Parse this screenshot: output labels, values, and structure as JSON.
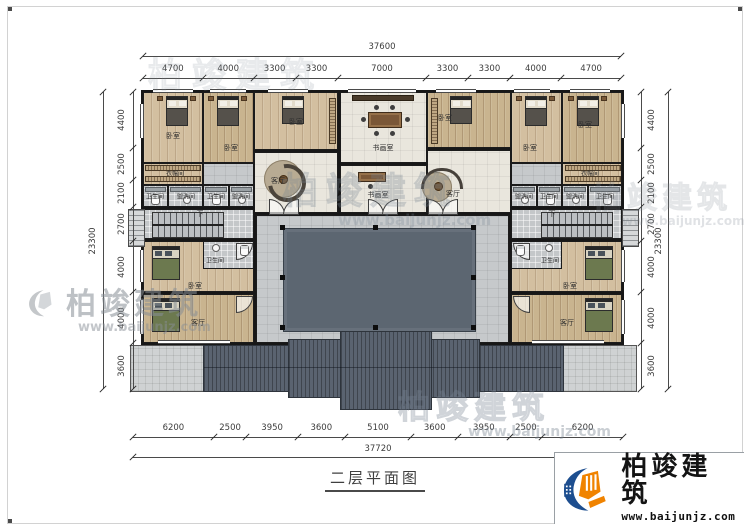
{
  "title": "二层平面图",
  "logo": {
    "name": "柏竣建筑",
    "url": "www.baijunjz.com"
  },
  "watermark": {
    "name": "柏竣建筑",
    "url": "www.baijunjz.com"
  },
  "labels": {
    "bedroom": "卧室",
    "living": "客厅",
    "study": "书画室",
    "cloak": "衣帽间",
    "bath": "卫生间",
    "wash": "盥洗间",
    "down": "下"
  },
  "dimensions": {
    "top": {
      "total": "37600",
      "segments": [
        "4700",
        "4000",
        "3300",
        "3300",
        "7000",
        "3300",
        "3300",
        "4000",
        "4700"
      ]
    },
    "bottom": {
      "total": "37720",
      "segments": [
        "6200",
        "2500",
        "3950",
        "3600",
        "5100",
        "3600",
        "3950",
        "2500",
        "6200"
      ]
    },
    "left": {
      "total": "23300",
      "segments": [
        "4400",
        "2500",
        "2100",
        "2700",
        "4000",
        "4000",
        "3600"
      ]
    },
    "right": {
      "total": "23300",
      "segments": [
        "4400",
        "2500",
        "2100",
        "2700",
        "4000",
        "4000",
        "3600"
      ]
    }
  },
  "colors": {
    "logo_blue": "#1d4e8f",
    "logo_orange": "#f08300",
    "roof_gray": "#5a6370",
    "wood_floor": "#d3bfa0",
    "tile_gray": "#c4c7c9",
    "courtyard_dark": "#5c6671"
  }
}
